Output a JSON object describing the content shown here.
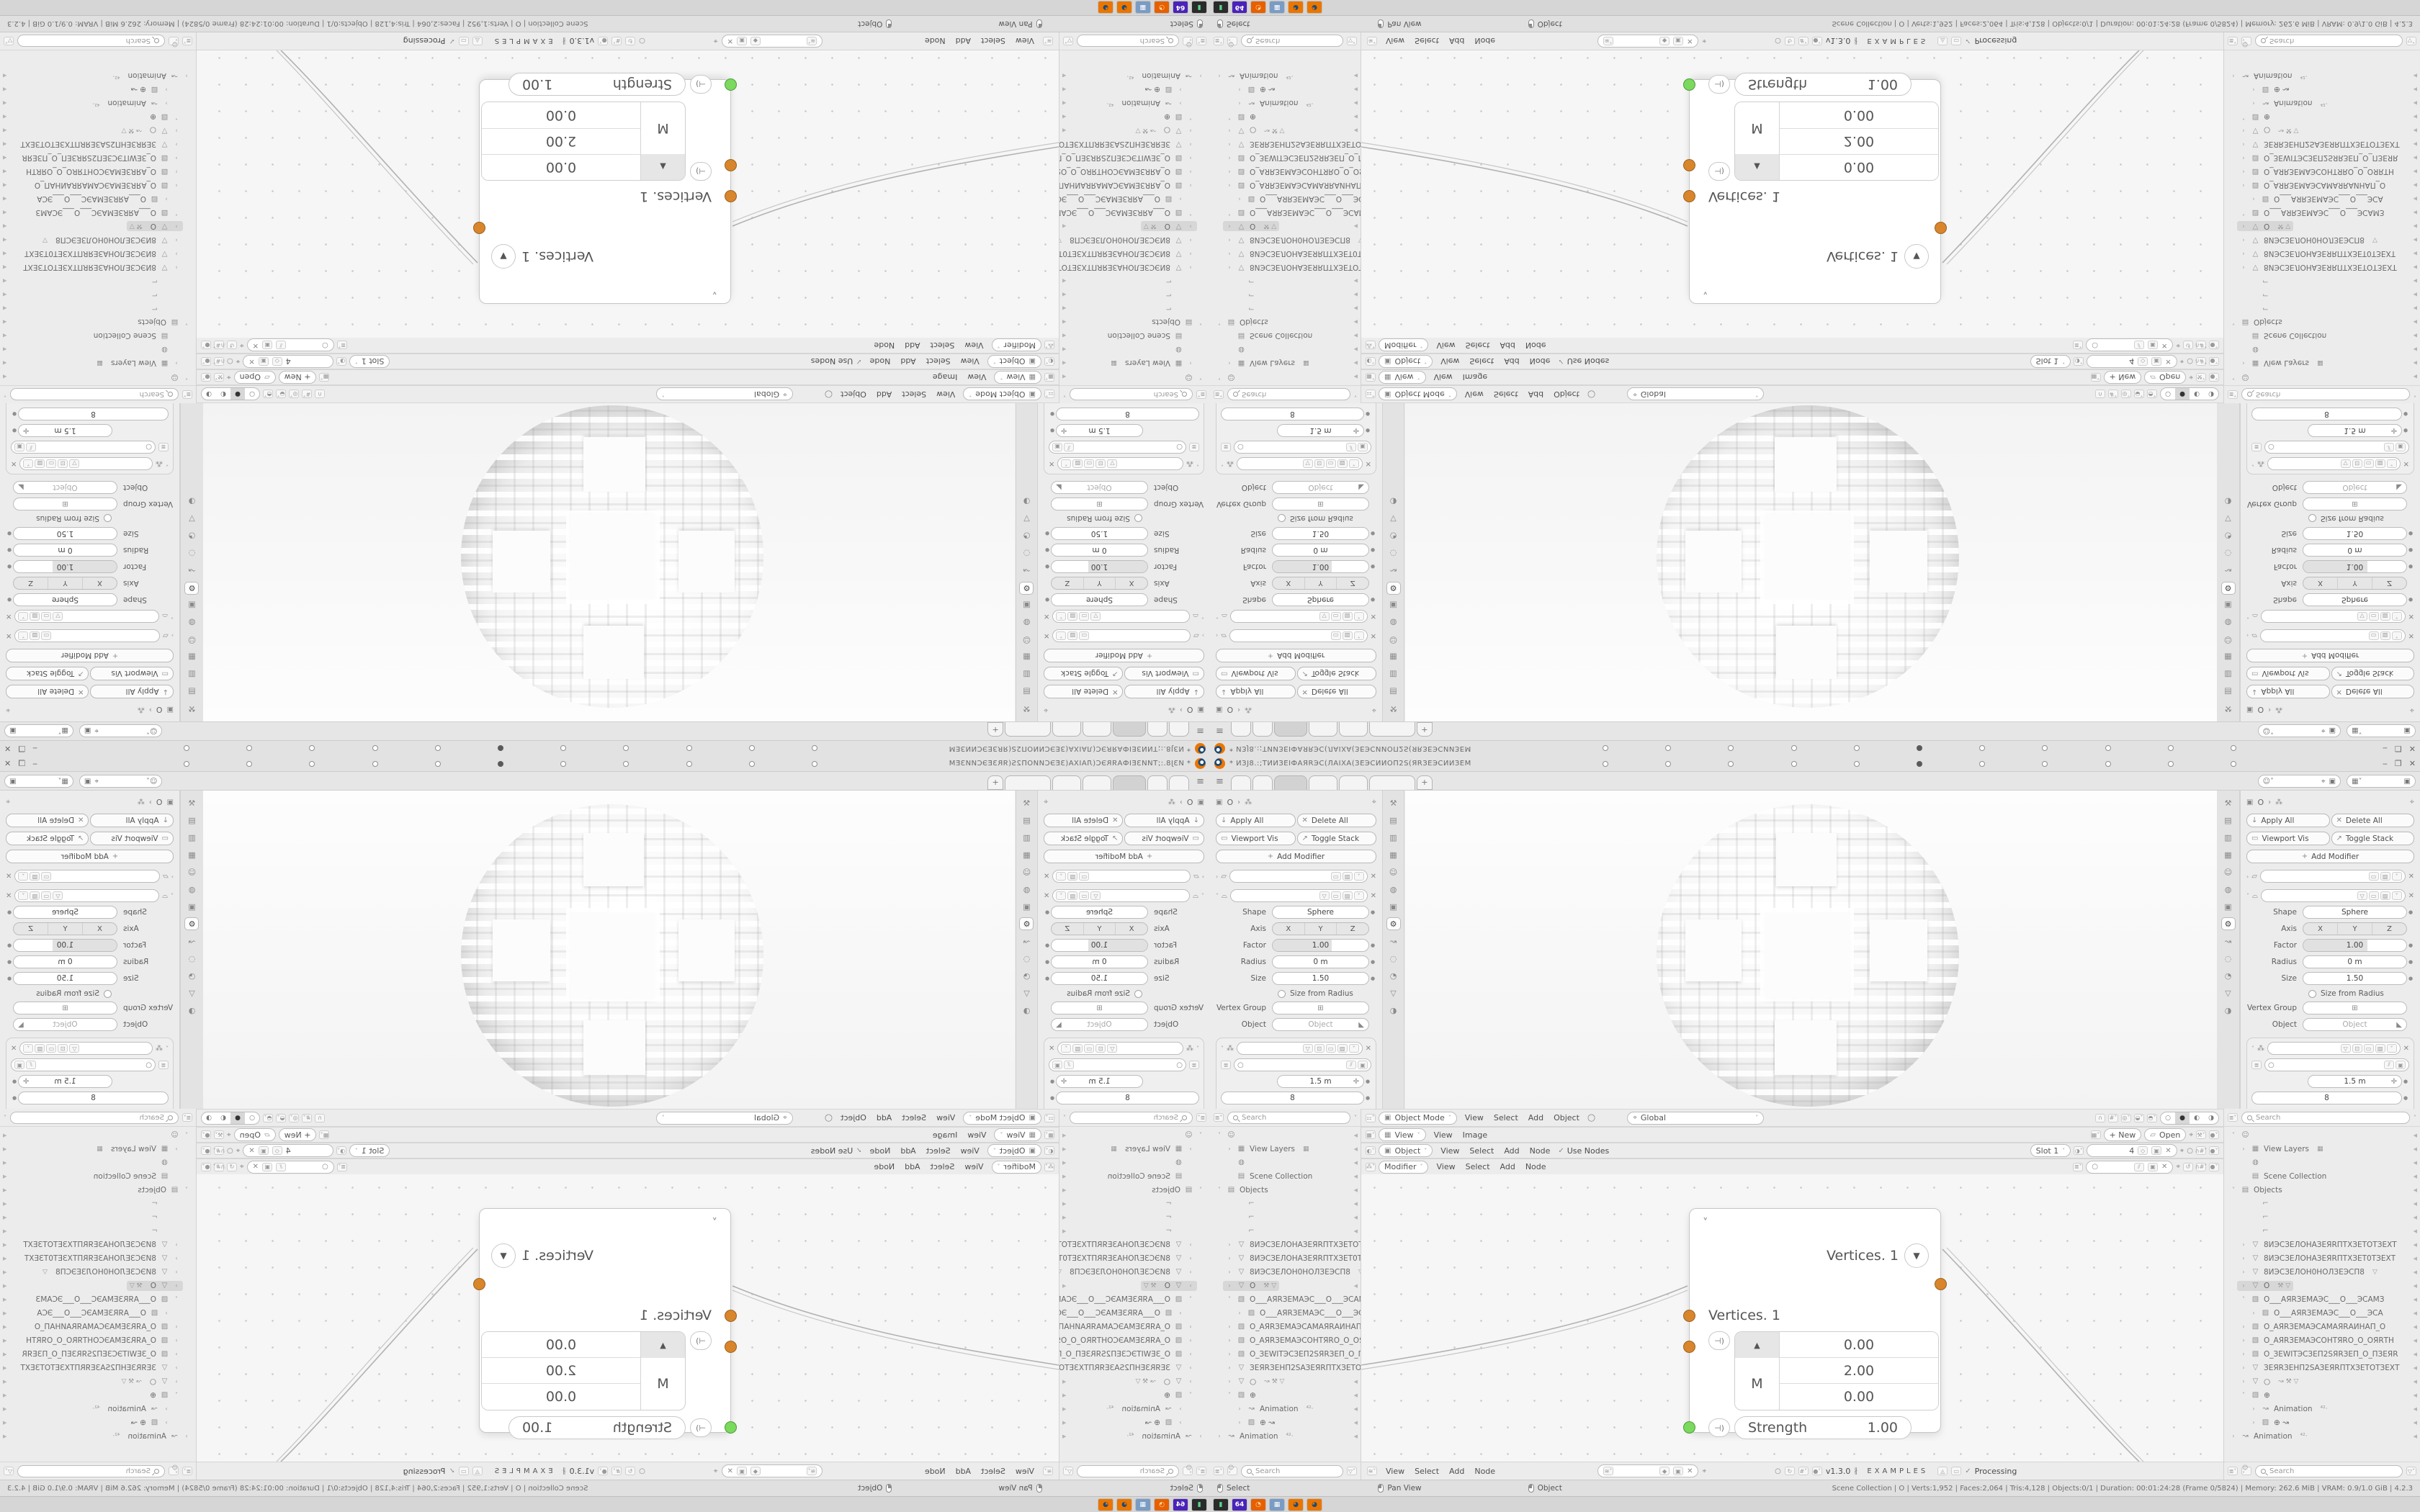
{
  "meta": {
    "app": "Blender desktop screenshot, 2x2 mirrored kaleidoscope; bottom-right quadrant is the unflipped copy"
  },
  "titlebar": {
    "title_left": "* ИЗЈ8.:;ТИИЗЕІФАЯRЭС(ЛАІХА(ЗЕЭСИИОП2S(ЯRЗЕЭСИИЗЕМ",
    "title_right": "МЗЕИИЭСЗЕЯRЭ2SПОИИЭСЗЕ(АХІАЛ(ЭСЯRАФЗЕИИТ.",
    "window_controls": [
      "‒",
      "❐",
      "✕"
    ],
    "keyframes": [
      0,
      0,
      0,
      0,
      0,
      1,
      0,
      0,
      0,
      0,
      0
    ]
  },
  "topbar": {
    "tabs": [
      28,
      28,
      46,
      40,
      40,
      64
    ],
    "active_tab": 2,
    "add_tab": "+",
    "scene_selector": {
      "icon": "scene-icon",
      "value": ""
    },
    "viewlayer_selector": {
      "icon": "viewlayer-icon",
      "value": ""
    }
  },
  "props": {
    "breadcrumb": {
      "object_icon": "▣",
      "object": "O",
      "sep": "›",
      "context_icon": "⁂"
    },
    "buttons": {
      "apply_all": "Apply All",
      "delete_all": "Delete All",
      "viewport_vis": "Viewport Vis",
      "toggle_stack": "Toggle Stack"
    },
    "add_modifier": "Add Modifier",
    "cast": {
      "shape_label": "Shape",
      "shape": "Sphere",
      "axis_label": "Axis",
      "axis": [
        "X",
        "Y",
        "Z"
      ],
      "factor_label": "Factor",
      "factor": "1.00",
      "radius_label": "Radius",
      "radius": "0 m",
      "size_label": "Size",
      "size": "1.50",
      "size_from_radius": "Size from Radius",
      "vertex_group_label": "Vertex Group",
      "object_label": "Object",
      "object_placeholder": "Object"
    },
    "geonodes": {
      "value1": "1.5 m",
      "value2": "8",
      "output_attributes": "Output Attributes",
      "manage": "Manage"
    },
    "tab_icons": [
      "⚒",
      "▤",
      "▥",
      "▦",
      "☺",
      "◍",
      "▣",
      "⚙",
      "↝",
      "◌",
      "◔",
      "▽",
      "◑"
    ],
    "active_tab_index": 7
  },
  "viewport_header": {
    "mode": "Object Mode",
    "menus": [
      "View",
      "Select",
      "Add",
      "Object"
    ],
    "orientation": "Global",
    "shading_modes": [
      "○",
      "●",
      "◐",
      "◑"
    ],
    "active_shading": 1
  },
  "image_header": {
    "context": "View",
    "menus": [
      "View",
      "Image"
    ],
    "new_button": "+ New",
    "open_button": "Open"
  },
  "shader_header": {
    "context": "Object",
    "menus": [
      "View",
      "Select",
      "Add",
      "Node"
    ],
    "use_nodes": "Use Nodes",
    "slot": "Slot 1",
    "users": "4"
  },
  "geo_header": {
    "context": "Modifier",
    "menus": [
      "View",
      "Select",
      "Add",
      "Node"
    ]
  },
  "node_editor_header": {
    "menus": [
      "View",
      "Select",
      "Add",
      "Node"
    ],
    "version": "v1.3.0",
    "examples": "EXAMPLES",
    "processing": "Processing",
    "check": "✓"
  },
  "outliner": {
    "search_placeholder": "Search",
    "rows": [
      {
        "chev": "˅",
        "icon": "☺",
        "label": "",
        "ind": 0
      },
      {
        "chev": "›",
        "icon": "▦",
        "label": "View Layers",
        "tail": "▦",
        "ind": 1
      },
      {
        "chev": "",
        "icon": "◍",
        "label": "",
        "ind": 1
      },
      {
        "chev": "",
        "icon": "▤",
        "label": "Scene Collection",
        "ind": 1
      },
      {
        "chev": "˅",
        "icon": "▤",
        "label": "Objects",
        "ind": 0
      },
      {
        "chev": "",
        "icon": "⌐",
        "label": "",
        "ind": 2
      },
      {
        "chev": "",
        "icon": "⌐",
        "label": "",
        "ind": 2
      },
      {
        "chev": "",
        "icon": "⌐",
        "label": "",
        "ind": 2
      },
      {
        "chev": "›",
        "icon": "▽",
        "label": "8ИЭСЗЕЛОНАЗЕЯRПТХЗЕТОТЗЕХТ",
        "ind": 1
      },
      {
        "chev": "›",
        "icon": "▽",
        "label": "8ИЭСЗЕЛОНАЗЕЯRПТХЗЕТ0ТЗЕХТ",
        "ind": 1
      },
      {
        "chev": "›",
        "icon": "▽",
        "label": "8ИЭСЗЕЛОН0НОЛЗЕЭСП8",
        "tail": "▽",
        "ind": 1
      },
      {
        "chev": "›",
        "icon": "▽",
        "label": "O",
        "tail": "⚒ ▽",
        "sel": true,
        "ind": 1
      },
      {
        "chev": "˅",
        "icon": "▧",
        "label": "O___АЯRЗЕМАЭС___O___ЭСАМЗ",
        "ind": 1
      },
      {
        "chev": "›",
        "icon": "▨",
        "label": "O___АЯRЗЕМАЭС___O___ЭСА",
        "ind": 2
      },
      {
        "chev": "›",
        "icon": "▧",
        "label": "O_АЯRЗЕМАЭСАМАЯRАИНАП_O",
        "ind": 1
      },
      {
        "chev": "›",
        "icon": "▧",
        "label": "O_АЯRЗЕМАЭСОНТЯRО_O_ОЯRТН",
        "ind": 1
      },
      {
        "chev": "›",
        "icon": "▧",
        "label": "O_ЗЕWІТЭСЗЕП2SЯRЗЕП_O_ПЗЕЯR",
        "ind": 1
      },
      {
        "chev": "›",
        "icon": "▽",
        "label": "ЗЕЯRЗЕНП2SАЗЕЯRПТХЗЕТОТЗЕХТ",
        "ind": 1
      },
      {
        "chev": "›",
        "icon": "▽",
        "label": "○",
        "tail": "↝ ⚒ ▽",
        "ind": 1
      },
      {
        "chev": "˅",
        "icon": "▧",
        "label": "⊕",
        "ind": 1
      },
      {
        "chev": "›",
        "icon": "↝",
        "label": "Animation",
        "tail": "⁴²·",
        "ind": 2
      },
      {
        "chev": "›",
        "icon": "▨",
        "label": "⊕   ↝",
        "ind": 2
      },
      {
        "chev": "›",
        "icon": "↝",
        "label": "Animation",
        "tail": "⁴²·",
        "ind": 0
      }
    ]
  },
  "node": {
    "output_label": "Vertices. 1",
    "input_label": "Vertices. 1",
    "vector_axis": "M",
    "vector_values": [
      "0.00",
      "2.00",
      "0.00"
    ],
    "strength_label": "Strength",
    "strength_value": "1.00",
    "socket_orange": "#d9852c",
    "socket_green": "#7bd95e"
  },
  "statusbar": {
    "hints": [
      "Select",
      "Pan View",
      "Object"
    ],
    "stats": "Scene Collection  |  O  |  Verts:1,952  |  Faces:2,064  |  Tris:4,128  |  Objects:0/1  |  Duration: 00:01:24:28 (Frame 0/5824)  |  Memory: 262.6 MiB  |  VRAM: 0.9/1.0 GiB  |  4.2.3"
  },
  "taskbar": {
    "icons": [
      {
        "name": "terminal-icon",
        "bg": "#2b2b2b",
        "glyph": "▮",
        "fg": "#58d68d"
      },
      {
        "name": "floppy-64-icon",
        "bg": "#4a23b8",
        "glyph": "64",
        "fg": "#ffffff"
      },
      {
        "name": "firefox-icon",
        "bg": "#e66000",
        "glyph": "◔",
        "fg": "#ffd9a0"
      },
      {
        "name": "calculator-icon",
        "bg": "#7a9cc4",
        "glyph": "▦",
        "fg": "#ffffff"
      },
      {
        "name": "blender-icon",
        "bg": "#ea7600",
        "glyph": "◕",
        "fg": "#1c4b7a"
      },
      {
        "name": "blender-icon",
        "bg": "#ea7600",
        "glyph": "◕",
        "fg": "#1c4b7a"
      }
    ]
  }
}
